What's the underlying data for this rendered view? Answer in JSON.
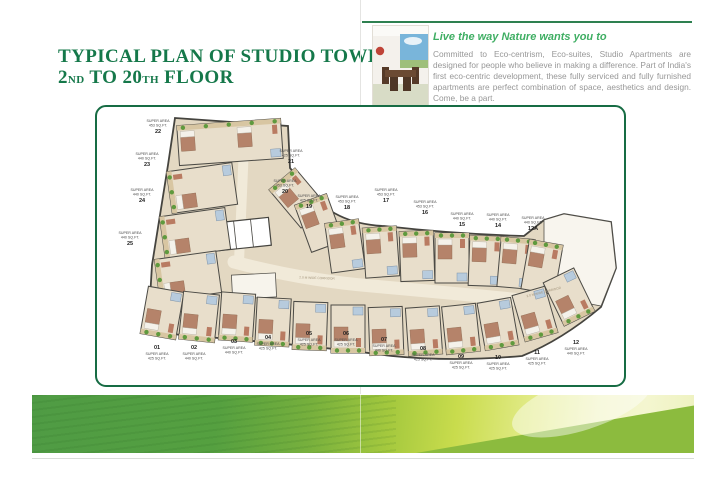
{
  "title": {
    "line1": "TYPICAL PLAN OF STUDIO TOWER",
    "line2": {
      "n1": "2",
      "o1": "ND",
      "mid": " TO 20",
      "o2": "TH",
      "end": " FLOOR"
    }
  },
  "intro": {
    "heading": "Live the way Nature wants you to",
    "body": "Committed to Eco-centrism, Eco-suites, Studio Apartments are designed for people who believe in making a difference. Part of India's first eco-centric development, these fully serviced and fully furnished apartments are perfect combination of space, aesthetics and design. Come, be a part."
  },
  "plan": {
    "corridor_label": "2.0 M WIDE CORRIDOR",
    "area_prefix": "SUPER AREA",
    "units": [
      {
        "number": "22",
        "area": "453 SQ.FT.",
        "side": "left"
      },
      {
        "number": "23",
        "area": "440 SQ.FT.",
        "side": "left"
      },
      {
        "number": "24",
        "area": "440 SQ.FT.",
        "side": "left"
      },
      {
        "number": "25",
        "area": "440 SQ.FT.",
        "side": "left"
      },
      {
        "number": "21",
        "area": "425 SQ.FT.",
        "side": "top"
      },
      {
        "number": "20",
        "area": "453 SQ.FT.",
        "side": "top"
      },
      {
        "number": "19",
        "area": "425 SQ.FT.",
        "side": "top"
      },
      {
        "number": "18",
        "area": "453 SQ.FT.",
        "side": "top"
      },
      {
        "number": "17",
        "area": "453 SQ.FT.",
        "side": "top"
      },
      {
        "number": "16",
        "area": "453 SQ.FT.",
        "side": "top"
      },
      {
        "number": "15",
        "area": "440 SQ.FT.",
        "side": "top"
      },
      {
        "number": "14",
        "area": "440 SQ.FT.",
        "side": "top"
      },
      {
        "number": "12A",
        "area": "440 SQ.FT.",
        "side": "top"
      },
      {
        "number": "01",
        "area": "425 SQ.FT.",
        "side": "bottom"
      },
      {
        "number": "02",
        "area": "440 SQ.FT.",
        "side": "bottom"
      },
      {
        "number": "03",
        "area": "440 SQ.FT.",
        "side": "bottom"
      },
      {
        "number": "04",
        "area": "425 SQ.FT.",
        "side": "bottom"
      },
      {
        "number": "05",
        "area": "425 SQ.FT.",
        "side": "bottom"
      },
      {
        "number": "06",
        "area": "425 SQ.FT.",
        "side": "bottom"
      },
      {
        "number": "07",
        "area": "440 SQ.FT.",
        "side": "bottom"
      },
      {
        "number": "08",
        "area": "425 SQ.FT.",
        "side": "bottom"
      },
      {
        "number": "09",
        "area": "425 SQ.FT.",
        "side": "bottom"
      },
      {
        "number": "10",
        "area": "425 SQ.FT.",
        "side": "bottom"
      },
      {
        "number": "11",
        "area": "425 SQ.FT.",
        "side": "bottom"
      },
      {
        "number": "12",
        "area": "440 SQ.FT.",
        "side": "bottom"
      }
    ]
  },
  "colors": {
    "brand_green": "#15784a",
    "heading_green": "#3fae63",
    "plan_border": "#176c44",
    "leaf_green": "#4f9b44",
    "leaf_pale": "#f1f4c2"
  }
}
